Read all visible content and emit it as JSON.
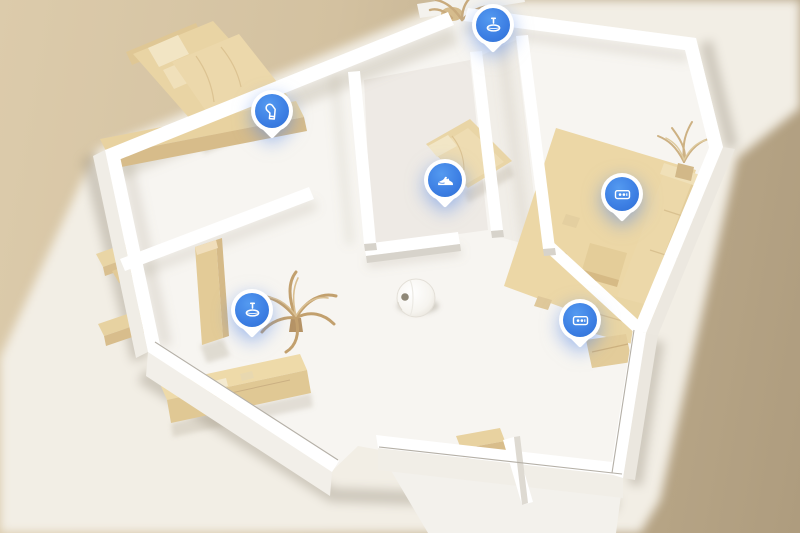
{
  "scene": {
    "description": "3D isometric home map with robot vacuum and obstacle markers",
    "colors": {
      "accent_blue": "#3C7EE3",
      "wall_white": "#FFFFFF",
      "floor": "#F7F5F1",
      "furniture_tan": "#EAD6A6",
      "furniture_shade": "#D9BF8E",
      "ground_cream": "#F2EEE5",
      "backdrop_left": "#DCCBAB",
      "backdrop_right": "#AE9C7E"
    }
  },
  "robot": {
    "name": "robot-vacuum",
    "x": 416,
    "y": 298
  },
  "markers": [
    {
      "id": "marker-balcony-mop",
      "icon": "mop-icon",
      "x": 493,
      "tip_y": 57
    },
    {
      "id": "marker-bedroom-sock",
      "icon": "sock-icon",
      "x": 272,
      "tip_y": 143
    },
    {
      "id": "marker-small-bedroom-shoe",
      "icon": "shoe-icon",
      "x": 445,
      "tip_y": 212
    },
    {
      "id": "marker-living-power-strip",
      "icon": "power-strip-icon",
      "x": 622,
      "tip_y": 226
    },
    {
      "id": "marker-hall-power-strip",
      "icon": "power-strip-icon",
      "x": 580,
      "tip_y": 352
    },
    {
      "id": "marker-bedroom2-mop",
      "icon": "mop-icon",
      "x": 252,
      "tip_y": 342
    }
  ],
  "furniture": [
    "double-bed",
    "bed-bench",
    "single-bed",
    "rug",
    "sofa",
    "coffee-table",
    "folded-mat",
    "sideboard",
    "wardrobe",
    "desk",
    "chair",
    "low-bench",
    "shoe-table",
    "palm-plant",
    "dried-plant-living-room",
    "dried-plant-balcony"
  ]
}
